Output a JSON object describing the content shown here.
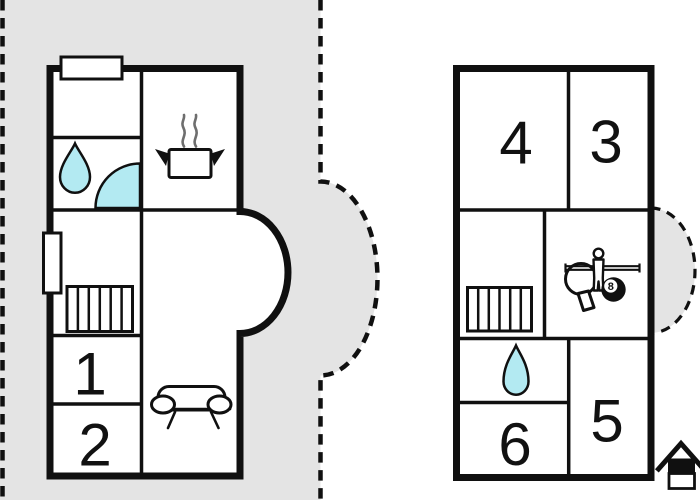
{
  "image_type": "floor-plan",
  "colors": {
    "canvas": "#ffffff",
    "terrace": "#e4e4e4",
    "wall": "#101010",
    "water": "#b3eaf2",
    "steam": "#6e6e6e",
    "number": "#111111"
  },
  "left_plan": {
    "label": "ground-floor-plan",
    "rooms": {
      "one": "1",
      "two": "2"
    },
    "features": [
      "chimney",
      "water-drop-icon",
      "shower-icon",
      "cooking-pot-icon",
      "steam-icon",
      "window",
      "stairs-icon",
      "sofa-icon",
      "bay-window",
      "dashed-terrace-outline"
    ]
  },
  "right_plan": {
    "label": "upper-floor-plan",
    "rooms": {
      "three": "3",
      "four": "4",
      "five": "5",
      "six": "6"
    },
    "features": [
      "stairs-icon",
      "table-tennis-icon",
      "foosball-player-icon",
      "billiard-ball-icon",
      "water-drop-icon",
      "dashed-balcony-outline"
    ],
    "billiard_ball_number": "8"
  },
  "corner_mark": {
    "icon": "house-icon"
  }
}
